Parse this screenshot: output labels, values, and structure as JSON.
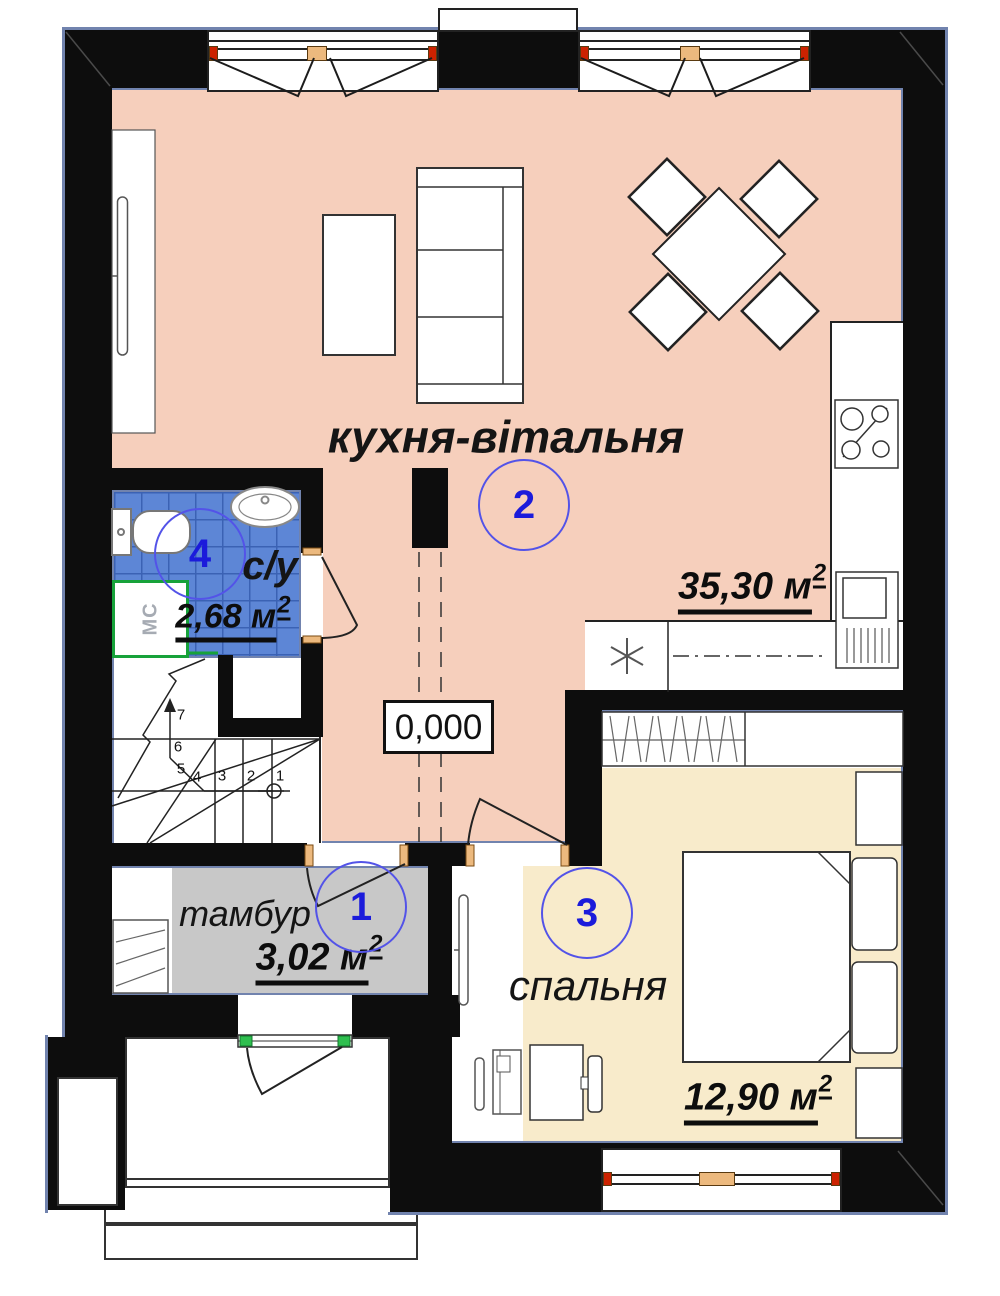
{
  "rooms": {
    "kitchen_living": {
      "number": "2",
      "label": "кухня-вітальня",
      "area": "35,30 м",
      "area_exp": "2"
    },
    "bathroom": {
      "number": "4",
      "label": "с/у",
      "area": "2,68 м",
      "area_exp": "2"
    },
    "vestibule": {
      "number": "1",
      "label": "тамбур",
      "area": "3,02 м",
      "area_exp": "2"
    },
    "bedroom": {
      "number": "3",
      "label": "спальня",
      "area": "12,90 м",
      "area_exp": "2"
    }
  },
  "marks": {
    "elevation": "0,000",
    "washing_machine": "МС"
  },
  "stairs": {
    "steps": [
      "1",
      "2",
      "3",
      "4",
      "5",
      "6",
      "7"
    ]
  },
  "colors": {
    "floor_living": "#f6cfbc",
    "floor_bedroom": "#f8ebcb",
    "floor_bathroom_tile": "#5d86d6",
    "floor_vestibule": "#c8c8c8",
    "wall": "#0d0d0d",
    "outline_blue": "#7183ae",
    "accent_number": "#1b1bdb",
    "accent_green": "#17a23a",
    "jamb_tan": "#ecb97e",
    "jamb_red": "#cc2200"
  }
}
